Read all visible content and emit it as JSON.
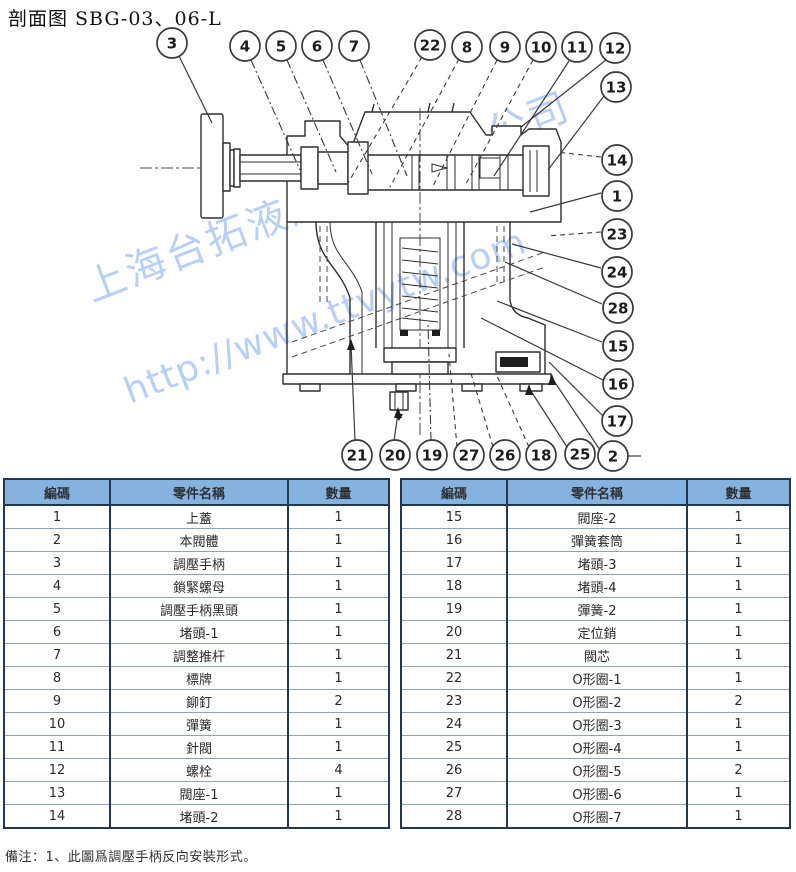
{
  "title": "剖面图 SBG-03、06-L",
  "watermark": {
    "company": "上海台拓液压机械有限公司",
    "url": "http://www.ttvytw.com",
    "color": "#7fa8ef"
  },
  "diagram": {
    "description": "cross-section of pressure control valve SBG-03/06-L",
    "callouts": [
      "3",
      "4",
      "5",
      "6",
      "7",
      "22",
      "8",
      "9",
      "10",
      "11",
      "12",
      "13",
      "14",
      "1",
      "23",
      "24",
      "28",
      "15",
      "16",
      "17",
      "21",
      "20",
      "19",
      "27",
      "26",
      "18",
      "25",
      "2"
    ]
  },
  "tables": {
    "headers": [
      "編碼",
      "零件名稱",
      "數量"
    ],
    "left": {
      "rows": [
        [
          "1",
          "上蓋",
          "1"
        ],
        [
          "2",
          "本閥體",
          "1"
        ],
        [
          "3",
          "調壓手柄",
          "1"
        ],
        [
          "4",
          "鎖緊螺母",
          "1"
        ],
        [
          "5",
          "調壓手柄黑頭",
          "1"
        ],
        [
          "6",
          "堵頭-1",
          "1"
        ],
        [
          "7",
          "調整推杆",
          "1"
        ],
        [
          "8",
          "標牌",
          "1"
        ],
        [
          "9",
          "鉚釘",
          "2"
        ],
        [
          "10",
          "彈簧",
          "1"
        ],
        [
          "11",
          "針閥",
          "1"
        ],
        [
          "12",
          "螺栓",
          "4"
        ],
        [
          "13",
          "閥座-1",
          "1"
        ],
        [
          "14",
          "堵頭-2",
          "1"
        ]
      ]
    },
    "right": {
      "rows": [
        [
          "15",
          "閥座-2",
          "1"
        ],
        [
          "16",
          "彈簧套筒",
          "1"
        ],
        [
          "17",
          "堵頭-3",
          "1"
        ],
        [
          "18",
          "堵頭-4",
          "1"
        ],
        [
          "19",
          "彈簧-2",
          "1"
        ],
        [
          "20",
          "定位銷",
          "1"
        ],
        [
          "21",
          "閥芯",
          "1"
        ],
        [
          "22",
          "O形圈-1",
          "1"
        ],
        [
          "23",
          "O形圈-2",
          "2"
        ],
        [
          "24",
          "O形圈-3",
          "1"
        ],
        [
          "25",
          "O形圈-4",
          "1"
        ],
        [
          "26",
          "O形圈-5",
          "2"
        ],
        [
          "27",
          "O形圈-6",
          "1"
        ],
        [
          "28",
          "O形圈-7",
          "1"
        ]
      ]
    }
  },
  "note": "備注：1、此圖爲調壓手柄反向安裝形式。"
}
